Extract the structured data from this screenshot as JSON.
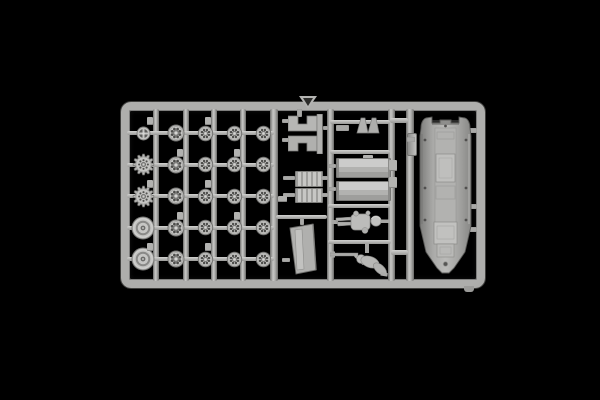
{
  "meta": {
    "type": "photograph",
    "description": "Light gray plastic scale-model kit sprue (parts tree) photographed on a pure black background: a rectangular runner frame holding rows of wheels, seats, brackets, two crew figures and a long vehicle hull part",
    "background_color": "#000000",
    "plastic_color": "#b4b4b2",
    "plastic_highlight": "#d4d4d2",
    "plastic_shadow": "#6c6c6a",
    "text_content": "none"
  },
  "sprue": {
    "wheel_grid": {
      "rows": 5,
      "cols": 5,
      "row_ys": [
        133,
        164.5,
        196,
        227.5,
        259
      ],
      "col_xs": [
        143,
        176,
        205,
        234,
        263
      ],
      "cell_types": [
        [
          "hub-wheel",
          "road-wheel-large",
          "road-wheel",
          "road-wheel",
          "road-wheel"
        ],
        [
          "sprocket-wheel",
          "road-wheel-large",
          "road-wheel",
          "road-wheel",
          "road-wheel"
        ],
        [
          "sprocket-wheel",
          "road-wheel-large",
          "road-wheel",
          "road-wheel",
          "road-wheel"
        ],
        [
          "idler-wheel",
          "road-wheel-large",
          "road-wheel",
          "road-wheel",
          "road-wheel"
        ],
        [
          "idler-wheel",
          "road-wheel-large",
          "road-wheel",
          "road-wheel",
          "road-wheel"
        ]
      ],
      "wheel_types": {
        "hub-wheel": {
          "label": "small spoked hub wheel",
          "radius": 6.5
        },
        "sprocket-wheel": {
          "label": "toothed drive sprocket wheel",
          "radius": 10.4,
          "teeth": 12,
          "holes": 8
        },
        "idler-wheel": {
          "label": "large idler wheel",
          "radius": 11
        },
        "road-wheel": {
          "label": "road wheel with lightening holes",
          "radius": 7.2,
          "holes": 8
        },
        "road-wheel-large": {
          "label": "road wheel with lightening holes",
          "radius": 8,
          "holes": 8
        }
      },
      "runner_xs": [
        153,
        183,
        211,
        240
      ],
      "tab_offset": [
        -6,
        -16
      ]
    },
    "parts": {
      "frame": {
        "label": "rectangular sprue runner frame"
      },
      "triangle_mark": {
        "label": "molded triangular arrow mark on top runner"
      },
      "bracket_pair": {
        "label": "pair of stepped brackets"
      },
      "ribbed_block_1": {
        "label": "ribbed block part"
      },
      "ribbed_block_2": {
        "label": "ribbed block part"
      },
      "door": {
        "label": "angled door / hatch panel"
      },
      "small_bar": {
        "label": "small bar part"
      },
      "wedge_pair": {
        "label": "pair of small wedge parts"
      },
      "bench_1": {
        "label": "bench seat part"
      },
      "bench_2": {
        "label": "bench seat part"
      },
      "figure_standing": {
        "label": "standing crew figure (molded sideways)"
      },
      "figure_prone": {
        "label": "prone crew figure with rifle"
      },
      "side_strip": {
        "label": "narrow strip part"
      },
      "hull": {
        "label": "long armored vehicle hull part with hatches and bolt detail"
      },
      "gate_stub": {
        "label": "sprue gate stub"
      },
      "gate_tab": {
        "label": "small molding tab"
      }
    }
  }
}
